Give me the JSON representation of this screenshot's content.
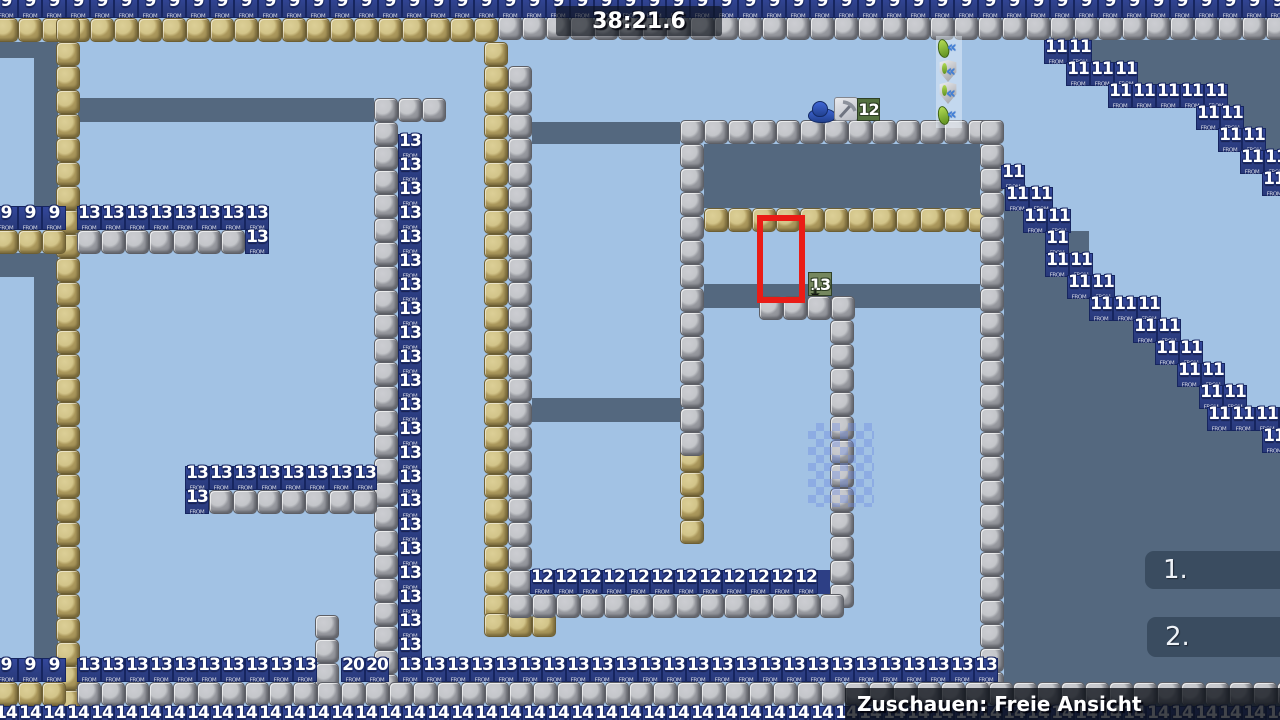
{
  "hud": {
    "timer": "38:21.6",
    "spectate_label": "Zuschauen: Freie Ansicht",
    "rank_panels": [
      "1.",
      "2."
    ]
  },
  "colors": {
    "background": "#a2c2e4",
    "slate": "#54687f",
    "navy": "#2d3f85",
    "red": "#ea1c16",
    "green_dark": "#53703f",
    "green_sage": "#75875e"
  },
  "map": {
    "tile_size": 24,
    "block_subtext": "FROM",
    "slate_rects": [
      [
        0,
        42,
        58,
        16
      ],
      [
        34,
        58,
        24,
        148
      ],
      [
        0,
        253,
        58,
        24
      ],
      [
        34,
        277,
        24,
        381
      ],
      [
        78,
        98,
        296,
        24
      ],
      [
        532,
        122,
        148,
        22
      ],
      [
        704,
        144,
        276,
        64
      ],
      [
        704,
        284,
        276,
        24
      ],
      [
        532,
        398,
        150,
        24
      ],
      [
        1088,
        40,
        192,
        22
      ],
      [
        1130,
        62,
        150,
        22
      ],
      [
        1218,
        84,
        62,
        22
      ],
      [
        1240,
        106,
        40,
        22
      ],
      [
        1262,
        128,
        18,
        22
      ],
      [
        1004,
        187,
        41,
        22
      ],
      [
        1004,
        209,
        63,
        22
      ],
      [
        1004,
        231,
        85,
        22
      ],
      [
        1004,
        253,
        85,
        22
      ],
      [
        1004,
        275,
        107,
        22
      ],
      [
        1004,
        297,
        151,
        22
      ],
      [
        1004,
        319,
        173,
        22
      ],
      [
        1004,
        341,
        195,
        22
      ],
      [
        1004,
        363,
        217,
        22
      ],
      [
        1004,
        385,
        203,
        22
      ],
      [
        1004,
        407,
        276,
        313
      ]
    ],
    "navy_rects": [
      [
        818,
        570,
        12,
        24
      ]
    ],
    "block_runs": [
      {
        "t": "tan",
        "x": -6,
        "y": 18,
        "n": 21,
        "dir": "h"
      },
      {
        "t": "tan",
        "x": 56,
        "y": 18,
        "n": 29,
        "dir": "v"
      },
      {
        "t": "tan",
        "x": -6,
        "y": 230,
        "n": 3,
        "dir": "h"
      },
      {
        "t": "tan",
        "x": 484,
        "y": 42,
        "n": 24,
        "dir": "v"
      },
      {
        "t": "tan",
        "x": 484,
        "y": 613,
        "n": 3,
        "dir": "h"
      },
      {
        "t": "tan",
        "x": 704,
        "y": 208,
        "n": 12,
        "dir": "h"
      },
      {
        "t": "tan",
        "x": 680,
        "y": 448,
        "n": 4,
        "dir": "v"
      },
      {
        "t": "tan",
        "x": -6,
        "y": 682,
        "n": 3,
        "dir": "h"
      },
      {
        "t": "grey",
        "x": 498,
        "y": 16,
        "n": 33,
        "dir": "h"
      },
      {
        "t": "grey",
        "x": 508,
        "y": 66,
        "n": 23,
        "dir": "v"
      },
      {
        "t": "grey",
        "x": 374,
        "y": 98,
        "n": 25,
        "dir": "v"
      },
      {
        "t": "grey",
        "x": 398,
        "y": 98,
        "n": 2,
        "dir": "h"
      },
      {
        "t": "grey",
        "x": 77,
        "y": 230,
        "n": 7,
        "dir": "h"
      },
      {
        "t": "grey",
        "x": 209,
        "y": 490,
        "n": 7,
        "dir": "h"
      },
      {
        "t": "grey",
        "x": 680,
        "y": 120,
        "n": 13,
        "dir": "h"
      },
      {
        "t": "grey",
        "x": 680,
        "y": 144,
        "n": 13,
        "dir": "v"
      },
      {
        "t": "grey",
        "x": 980,
        "y": 120,
        "n": 24,
        "dir": "v"
      },
      {
        "t": "grey",
        "x": 830,
        "y": 296,
        "n": 13,
        "dir": "v"
      },
      {
        "t": "grey",
        "x": 759,
        "y": 296,
        "n": 4,
        "dir": "h"
      },
      {
        "t": "grey",
        "x": 508,
        "y": 594,
        "n": 14,
        "dir": "h"
      },
      {
        "t": "grey",
        "x": 315,
        "y": 615,
        "n": 3,
        "dir": "v"
      },
      {
        "t": "grey",
        "x": 77,
        "y": 682,
        "n": 51,
        "dir": "h"
      }
    ],
    "number_runs": [
      {
        "label": "9",
        "x": -6,
        "y": -6,
        "n": 54,
        "dir": "h"
      },
      {
        "label": "9",
        "x": -6,
        "y": 206,
        "n": 3,
        "dir": "h"
      },
      {
        "label": "13",
        "x": 77,
        "y": 206,
        "n": 8,
        "dir": "h"
      },
      {
        "label": "13",
        "x": 245,
        "y": 230,
        "n": 1,
        "dir": "h"
      },
      {
        "label": "13",
        "x": 398,
        "y": 134,
        "n": 22,
        "dir": "v"
      },
      {
        "label": "13",
        "x": 185,
        "y": 466,
        "n": 8,
        "dir": "h"
      },
      {
        "label": "13",
        "x": 185,
        "y": 490,
        "n": 1,
        "dir": "h"
      },
      {
        "label": "12",
        "x": 530,
        "y": 570,
        "n": 12,
        "dir": "h"
      },
      {
        "label": "11",
        "x": 1044,
        "y": 40,
        "n": 2,
        "dir": "h"
      },
      {
        "label": "11",
        "x": 1066,
        "y": 62,
        "n": 3,
        "dir": "h"
      },
      {
        "label": "11",
        "x": 1108,
        "y": 84,
        "n": 5,
        "dir": "h"
      },
      {
        "label": "11",
        "x": 1196,
        "y": 106,
        "n": 2,
        "dir": "h"
      },
      {
        "label": "11",
        "x": 1218,
        "y": 128,
        "n": 2,
        "dir": "h"
      },
      {
        "label": "11",
        "x": 1240,
        "y": 150,
        "n": 2,
        "dir": "h"
      },
      {
        "label": "11",
        "x": 1262,
        "y": 172,
        "n": 1,
        "dir": "h"
      },
      {
        "label": "11",
        "x": 1001,
        "y": 165,
        "n": 1,
        "dir": "h"
      },
      {
        "label": "11",
        "x": 1005,
        "y": 187,
        "n": 2,
        "dir": "h"
      },
      {
        "label": "11",
        "x": 1023,
        "y": 209,
        "n": 2,
        "dir": "h"
      },
      {
        "label": "11",
        "x": 1045,
        "y": 231,
        "n": 1,
        "dir": "h"
      },
      {
        "label": "11",
        "x": 1045,
        "y": 253,
        "n": 2,
        "dir": "h"
      },
      {
        "label": "11",
        "x": 1067,
        "y": 275,
        "n": 2,
        "dir": "h"
      },
      {
        "label": "11",
        "x": 1089,
        "y": 297,
        "n": 3,
        "dir": "h"
      },
      {
        "label": "11",
        "x": 1133,
        "y": 319,
        "n": 2,
        "dir": "h"
      },
      {
        "label": "11",
        "x": 1155,
        "y": 341,
        "n": 2,
        "dir": "h"
      },
      {
        "label": "11",
        "x": 1177,
        "y": 363,
        "n": 2,
        "dir": "h"
      },
      {
        "label": "11",
        "x": 1199,
        "y": 385,
        "n": 2,
        "dir": "h"
      },
      {
        "label": "11",
        "x": 1207,
        "y": 407,
        "n": 4,
        "dir": "h"
      },
      {
        "label": "11",
        "x": 1262,
        "y": 429,
        "n": 1,
        "dir": "h"
      },
      {
        "label": "9",
        "x": -6,
        "y": 658,
        "n": 3,
        "dir": "h"
      },
      {
        "label": "13",
        "x": 77,
        "y": 658,
        "n": 10,
        "dir": "h"
      },
      {
        "label": "20",
        "x": 341,
        "y": 658,
        "n": 2,
        "dir": "h"
      },
      {
        "label": "13",
        "x": 398,
        "y": 658,
        "n": 25,
        "dir": "h"
      },
      {
        "label": "14",
        "x": -6,
        "y": 706,
        "n": 54,
        "dir": "h"
      }
    ],
    "specials": {
      "worm_marker_value": "12",
      "target_marker_value": "13",
      "icon_strip": [
        {
          "type": "leaf-left",
          "x": 936,
          "y": 37
        },
        {
          "type": "shield",
          "x": 936,
          "y": 60
        },
        {
          "type": "shield",
          "x": 936,
          "y": 82
        },
        {
          "type": "leaf-left",
          "x": 936,
          "y": 104
        }
      ]
    }
  }
}
